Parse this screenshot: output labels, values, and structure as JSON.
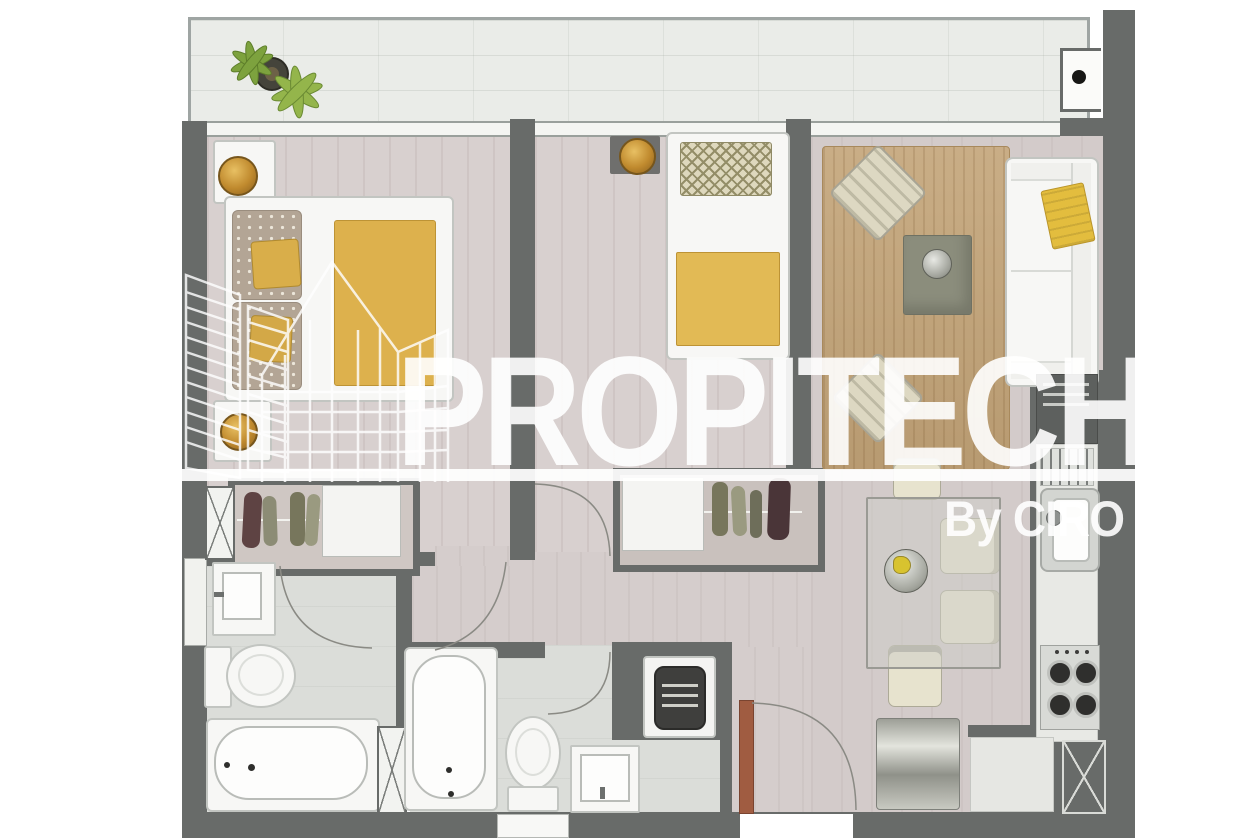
{
  "watermark": {
    "brand": "PROPITECH",
    "byline": "By CIRO",
    "logo_icon": "buildings-outline-logo",
    "color": "#ffffff"
  },
  "palette": {
    "wall": "#686b69",
    "bedroomFloor": "#d8d0cf",
    "livingFloor": "#d3cbca",
    "hallFloor": "#d5cdcc",
    "bathFloor": "#dbddd9",
    "balconyFloor": "#eaece8",
    "rugWood": "#c3a478",
    "accentYellow": "#ddb14d",
    "gold": "#c79436",
    "cream": "#e7e3ce",
    "doorRed": "#a05c41",
    "plantGreen": "#7da23e"
  },
  "floorplan": {
    "type": "apartment-floor-plan-top-view",
    "rooms": [
      {
        "name": "balcony",
        "items": [
          "potted-plant",
          "ceiling-light-box"
        ]
      },
      {
        "name": "master-bedroom",
        "items": [
          "double-bed",
          "nightstand-lamp",
          "nightstand-lamp",
          "wardrobe-sliding",
          "duct-shaft"
        ]
      },
      {
        "name": "bedroom-2",
        "items": [
          "single-bed",
          "table-lamp",
          "wardrobe-sliding"
        ]
      },
      {
        "name": "living-dining",
        "items": [
          "sofa",
          "throw-blanket",
          "armchair",
          "armchair",
          "coffee-table",
          "area-rug",
          "dining-table",
          "dining-chair",
          "dining-chair",
          "dining-chair",
          "dining-chair",
          "centerpiece-bowl",
          "console-sideboard"
        ]
      },
      {
        "name": "kitchen",
        "items": [
          "refrigerator",
          "drying-rack",
          "sink",
          "counter",
          "cooktop-4-burner",
          "duct-shaft"
        ]
      },
      {
        "name": "bathroom-1",
        "items": [
          "washbasin",
          "toilet",
          "bathtub",
          "window"
        ]
      },
      {
        "name": "bathroom-2",
        "items": [
          "bathtub",
          "toilet",
          "washbasin",
          "washing-machine",
          "duct-shaft",
          "window"
        ]
      },
      {
        "name": "hallway",
        "items": [
          "door-arc",
          "door-arc",
          "door-arc",
          "door-arc"
        ]
      },
      {
        "name": "entry",
        "items": [
          "entry-door",
          "door-arc"
        ]
      }
    ]
  }
}
